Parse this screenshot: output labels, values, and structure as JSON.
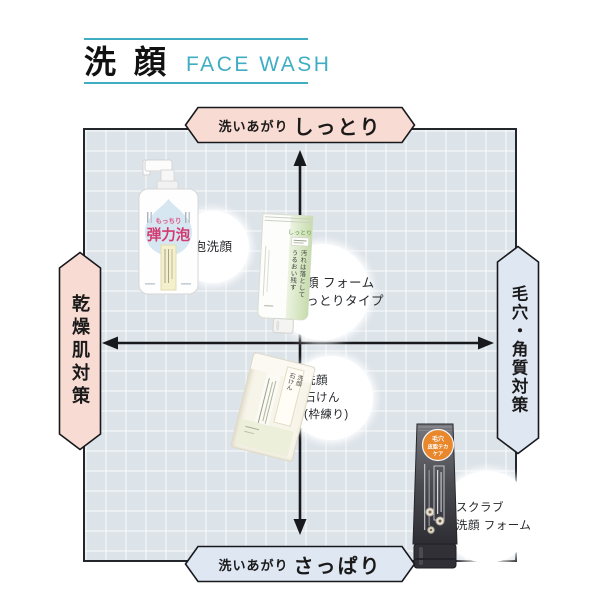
{
  "header": {
    "title": "洗顔",
    "subtitle": "FACE WASH"
  },
  "axes": {
    "top": {
      "prefix": "洗いあがり",
      "label": "しっとり"
    },
    "bottom": {
      "prefix": "洗いあがり",
      "label": "さっぱり"
    },
    "left": {
      "label": "乾燥肌対策"
    },
    "right": {
      "label": "毛穴・角質対策"
    }
  },
  "products": {
    "foam_wash": {
      "quadrant": "upper-left",
      "callout": "泡洗顔",
      "package": {
        "tagline_small": "もっちり",
        "tagline_big": "弾力泡"
      }
    },
    "moist_foam": {
      "quadrant": "upper-center",
      "callout_line1": "洗顔 フォーム",
      "callout_line2": "しっとりタイプ",
      "package": {
        "type_label": "しっとり",
        "copy": "汚れは落として\nうるおい残す"
      }
    },
    "soap": {
      "quadrant": "lower-center",
      "callout_line1": "洗顔",
      "callout_line2": "石けん",
      "callout_line3": "(枠練り)",
      "package": {
        "label": "洗顔\n石けん"
      }
    },
    "scrub_foam": {
      "quadrant": "lower-right",
      "callout_line1": "スクラブ",
      "callout_line2": "洗顔 フォーム",
      "package": {
        "badge_line1": "毛穴",
        "badge_line2": "皮脂テカ",
        "badge_line3": "ケア"
      }
    }
  },
  "colors": {
    "accent_teal": "#3fadc2",
    "badge_pink": "#f8dbd2",
    "badge_blue": "#dfe7f3",
    "chart_bg": "#dce3e9",
    "scrub_badge_orange": "#e8872c",
    "tagline_pink": "#d23a72"
  }
}
